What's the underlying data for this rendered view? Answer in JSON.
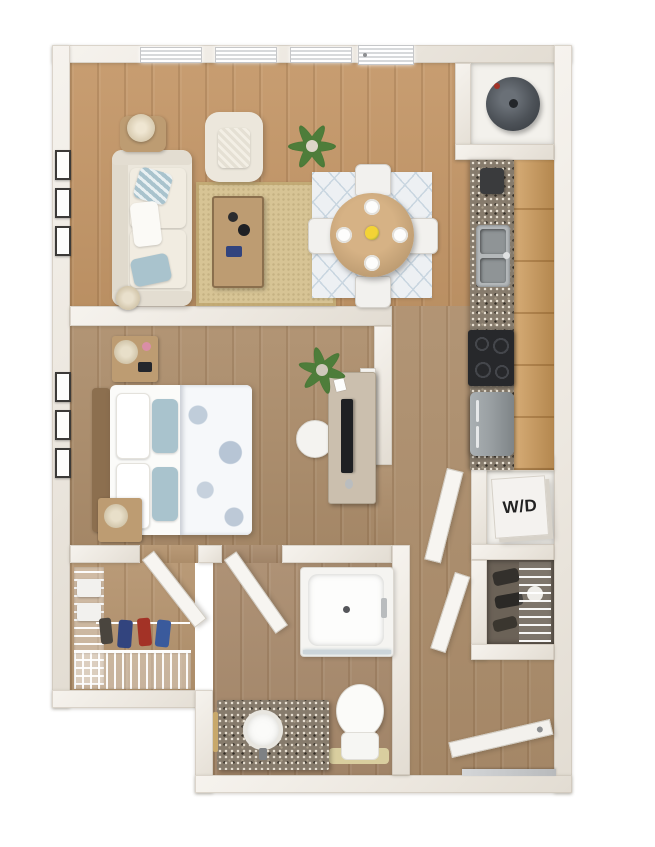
{
  "scene": {
    "type": "3d-floor-plan-render",
    "rooms": [
      "living-room",
      "dining-area",
      "kitchen",
      "bedroom",
      "walk-in-closet",
      "bathroom",
      "hallway",
      "entry",
      "washer-dryer-closet",
      "linen-closet",
      "water-heater-closet"
    ],
    "furniture": [
      "sofa",
      "armchair",
      "coffee-table",
      "side-table",
      "table-lamp",
      "jute-rug",
      "dining-table",
      "dining-chairs",
      "dining-rug",
      "kitchen-sink",
      "stove",
      "refrigerator",
      "water-heater",
      "bed",
      "nightstands",
      "desk",
      "desk-chair",
      "shower",
      "toilet",
      "vanity-sink",
      "wire-shelving",
      "potted-plants"
    ]
  },
  "labels": {
    "washer_dryer": "W/D"
  },
  "colors": {
    "bg": "#ffffff",
    "floor_warm": "#c49768",
    "floor_cool": "#ad8e6c",
    "floor_bath": "#a98b6d",
    "floor_closet": "#b5946f",
    "rug_jute": "#d7c495",
    "rug_dining": "#edf0f3",
    "rug_dining_pattern": "#c9d6e0",
    "sofa": "#ece7dc",
    "cushion_blue": "#a9c3cd",
    "wood_furniture": "#bd9c72",
    "cabinet": "#cd9a59",
    "granite_base": "#867b6c",
    "appliance_dark": "#27282b",
    "steel": "#9aa0a3",
    "water_heater": "#4d5258",
    "plant_green": "#4e7d3a",
    "white_fixture": "#fbfbf9",
    "accent_red": "#a33226",
    "accent_blue": "#32447e",
    "door": "#f7f5f1",
    "label_text": "#222222"
  }
}
